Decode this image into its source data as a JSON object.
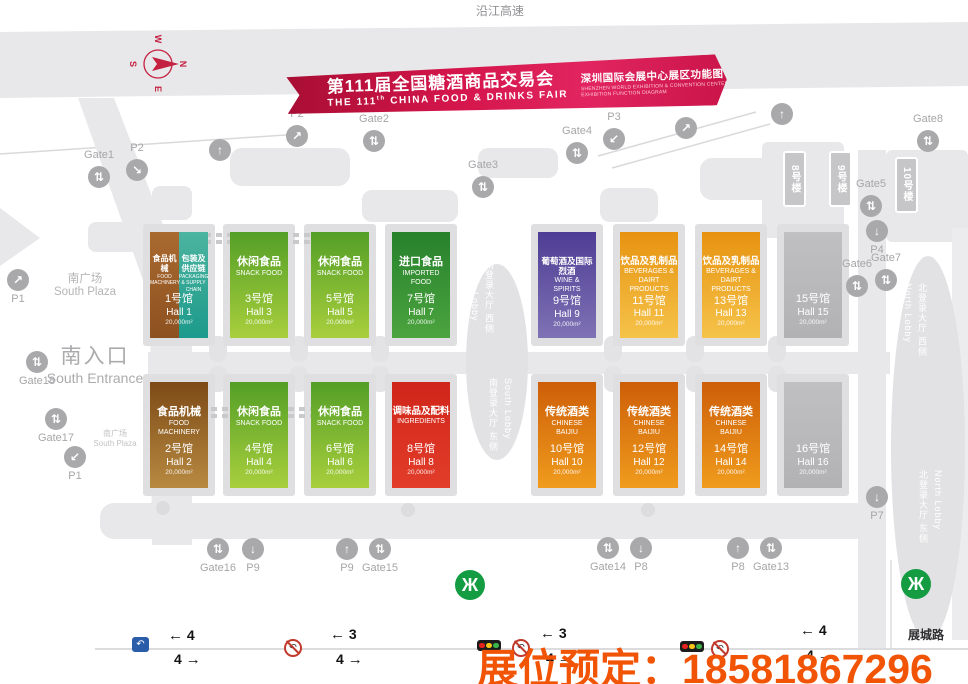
{
  "page": {
    "highway_label": "沿江高速",
    "road_label": "展城路",
    "booking_overlay": "展位预定：18581867296",
    "booking_color": "#f25405"
  },
  "banner": {
    "title_cn": "第111届全国糖酒商品交易会",
    "title_en_prefix": "THE 111",
    "title_en_sup": "th",
    "title_en_suffix": " CHINA FOOD & DRINKS FAIR",
    "subtitle_cn": "深圳国际会展中心展区功能图",
    "subtitle_en_line1": "SHENZHEN WORLD EXHIBITION & CONVENTION CENTER",
    "subtitle_en_line2": "EXHIBITION FUNCTION DIAGRAM"
  },
  "compass": {
    "letters": [
      "N",
      "E",
      "S",
      "W"
    ]
  },
  "areas": {
    "south_plaza": {
      "cn": "南广场",
      "en": "South Plaza"
    },
    "south_plaza_small": {
      "cn": "南广场",
      "en": "South Plaza"
    },
    "south_entrance": {
      "cn": "南入口",
      "en": "South Entrance"
    },
    "south_lobby_west": {
      "cn": "南登录大厅 西侧",
      "en": "South Lobby"
    },
    "south_lobby_east": {
      "cn": "南登录大厅 东侧",
      "en": "South Lobby"
    },
    "north_lobby_west": {
      "cn": "北登录大厅 西侧",
      "en": "North Lobby"
    },
    "north_lobby_east": {
      "cn": "北登录大厅 东侧",
      "en": "North Lobby"
    }
  },
  "buildings": [
    {
      "label": "8号楼",
      "x": 783,
      "y": 151
    },
    {
      "label": "9号楼",
      "x": 829,
      "y": 151
    },
    {
      "label": "10号楼",
      "x": 895,
      "y": 157
    }
  ],
  "halls": [
    {
      "num": "1",
      "row": 1,
      "col": 0,
      "split": true,
      "name_cn": "食品机械",
      "name_en": "FOOD MACHINERY",
      "name2_cn": "包装及供应链",
      "name2_en": "PACKAGING & SUPPLY CHAIN",
      "hall_cn": "1号馆",
      "hall_en": "Hall 1",
      "area": "20,000m²",
      "color_top": "#a96a30",
      "color_bottom": "#8d5120",
      "color2_top": "#4cb4a0",
      "color2_bottom": "#1c9a8b"
    },
    {
      "num": "3",
      "row": 1,
      "col": 1,
      "name_cn": "休闲食品",
      "name_en": "SNACK FOOD",
      "hall_cn": "3号馆",
      "hall_en": "Hall 3",
      "area": "20,000m²",
      "color_top": "#549f27",
      "color_bottom": "#a9cf3d"
    },
    {
      "num": "5",
      "row": 1,
      "col": 2,
      "name_cn": "休闲食品",
      "name_en": "SNACK FOOD",
      "hall_cn": "5号馆",
      "hall_en": "Hall 5",
      "area": "20,000m²",
      "color_top": "#549f27",
      "color_bottom": "#a9cf3d"
    },
    {
      "num": "7",
      "row": 1,
      "col": 3,
      "name_cn": "进口食品",
      "name_en": "IMPORTED FOOD",
      "hall_cn": "7号馆",
      "hall_en": "Hall 7",
      "area": "20,000m²",
      "color_top": "#27812c",
      "color_bottom": "#4ba43e"
    },
    {
      "num": "9",
      "row": 1,
      "col": 4,
      "name_cn": "葡萄酒及国际烈酒",
      "name_en": "WINE & SPIRITS",
      "hall_cn": "9号馆",
      "hall_en": "Hall 9",
      "area": "20,000m²",
      "color_top": "#4e3d95",
      "color_bottom": "#7f72b4"
    },
    {
      "num": "11",
      "row": 1,
      "col": 5,
      "name_cn": "饮品及乳制品",
      "name_en": "BEVERAGES & DAIRT PRODUCTS",
      "hall_cn": "11号馆",
      "hall_en": "Hall 11",
      "area": "20,000m²",
      "color_top": "#e79310",
      "color_bottom": "#f5c34a"
    },
    {
      "num": "13",
      "row": 1,
      "col": 6,
      "name_cn": "饮品及乳制品",
      "name_en": "BEVERAGES & DAIRT PRODUCTS",
      "hall_cn": "13号馆",
      "hall_en": "Hall 13",
      "area": "20,000m²",
      "color_top": "#e79310",
      "color_bottom": "#f5c34a"
    },
    {
      "num": "15",
      "row": 1,
      "col": 7,
      "name_cn": "",
      "name_en": "",
      "hall_cn": "15号馆",
      "hall_en": "Hall 15",
      "area": "20,000m²",
      "color_top": "#c0c0c2",
      "color_bottom": "#b2b2b4"
    },
    {
      "num": "2",
      "row": 2,
      "col": 0,
      "name_cn": "食品机械",
      "name_en": "FOOD MACHINERY",
      "hall_cn": "2号馆",
      "hall_en": "Hall 2",
      "area": "20,000m²",
      "color_top": "#7d4a16",
      "color_bottom": "#b78a41"
    },
    {
      "num": "4",
      "row": 2,
      "col": 1,
      "name_cn": "休闲食品",
      "name_en": "SNACK FOOD",
      "hall_cn": "4号馆",
      "hall_en": "Hall 4",
      "area": "20,000m²",
      "color_top": "#549f27",
      "color_bottom": "#a9cf3d"
    },
    {
      "num": "6",
      "row": 2,
      "col": 2,
      "name_cn": "休闲食品",
      "name_en": "SNACK FOOD",
      "hall_cn": "6号馆",
      "hall_en": "Hall 6",
      "area": "20,000m²",
      "color_top": "#549f27",
      "color_bottom": "#a9cf3d"
    },
    {
      "num": "8",
      "row": 2,
      "col": 3,
      "name_cn": "调味品及配料",
      "name_en": "INGREDIENTS",
      "hall_cn": "8号馆",
      "hall_en": "Hall 8",
      "area": "20,000m²",
      "color_top": "#d0251a",
      "color_bottom": "#e23d2a"
    },
    {
      "num": "10",
      "row": 2,
      "col": 4,
      "name_cn": "传统酒类",
      "name_en": "CHINESE BAIJIU",
      "hall_cn": "10号馆",
      "hall_en": "Hall 10",
      "area": "20,000m²",
      "color_top": "#cd5e08",
      "color_bottom": "#f09c1d"
    },
    {
      "num": "12",
      "row": 2,
      "col": 5,
      "name_cn": "传统酒类",
      "name_en": "CHINESE BAIJIU",
      "hall_cn": "12号馆",
      "hall_en": "Hall 12",
      "area": "20,000m²",
      "color_top": "#cd5e08",
      "color_bottom": "#f09c1d"
    },
    {
      "num": "14",
      "row": 2,
      "col": 6,
      "name_cn": "传统酒类",
      "name_en": "CHINESE BAIJIU",
      "hall_cn": "14号馆",
      "hall_en": "Hall 14",
      "area": "20,000m²",
      "color_top": "#cd5e08",
      "color_bottom": "#f09c1d"
    },
    {
      "num": "16",
      "row": 2,
      "col": 7,
      "name_cn": "",
      "name_en": "",
      "hall_cn": "16号馆",
      "hall_en": "Hall 16",
      "area": "20,000m²",
      "color_top": "#c0c0c2",
      "color_bottom": "#b2b2b4"
    }
  ],
  "gates": [
    {
      "label": "Gate1",
      "cx": 99,
      "cy": 177,
      "arrow": "⇅",
      "label_pos": "above"
    },
    {
      "label": "P2",
      "cx": 137,
      "cy": 170,
      "arrow": "↘",
      "label_pos": "above"
    },
    {
      "label": "",
      "cx": 220,
      "cy": 150,
      "arrow": "↑",
      "label_pos": "above"
    },
    {
      "label": "P2",
      "cx": 297,
      "cy": 136,
      "arrow": "↗",
      "label_pos": "above"
    },
    {
      "label": "Gate2",
      "cx": 374,
      "cy": 141,
      "arrow": "⇅",
      "label_pos": "above"
    },
    {
      "label": "Gate3",
      "cx": 483,
      "cy": 187,
      "arrow": "⇅",
      "label_pos": "above"
    },
    {
      "label": "Gate4",
      "cx": 577,
      "cy": 153,
      "arrow": "⇅",
      "label_pos": "above"
    },
    {
      "label": "P3",
      "cx": 614,
      "cy": 139,
      "arrow": "↙",
      "label_pos": "above"
    },
    {
      "label": "",
      "cx": 686,
      "cy": 128,
      "arrow": "↗",
      "label_pos": "above"
    },
    {
      "label": "",
      "cx": 782,
      "cy": 114,
      "arrow": "↑",
      "label_pos": "above"
    },
    {
      "label": "Gate8",
      "cx": 928,
      "cy": 141,
      "arrow": "⇅",
      "label_pos": "above"
    },
    {
      "label": "Gate5",
      "cx": 871,
      "cy": 206,
      "arrow": "⇅",
      "label_pos": "above"
    },
    {
      "label": "P4",
      "cx": 877,
      "cy": 231,
      "arrow": "↓",
      "label_pos": "below"
    },
    {
      "label": "Gate6",
      "cx": 857,
      "cy": 286,
      "arrow": "⇅",
      "label_pos": "above"
    },
    {
      "label": "Gate7",
      "cx": 886,
      "cy": 280,
      "arrow": "⇅",
      "label_pos": "above"
    },
    {
      "label": "P1",
      "cx": 18,
      "cy": 280,
      "arrow": "↗",
      "label_pos": "below"
    },
    {
      "label": "Gate18",
      "cx": 37,
      "cy": 362,
      "arrow": "⇅",
      "label_pos": "below"
    },
    {
      "label": "Gate17",
      "cx": 56,
      "cy": 419,
      "arrow": "⇅",
      "label_pos": "below"
    },
    {
      "label": "P1",
      "cx": 75,
      "cy": 457,
      "arrow": "↙",
      "label_pos": "below"
    },
    {
      "label": "Gate16",
      "cx": 218,
      "cy": 549,
      "arrow": "⇅",
      "label_pos": "below"
    },
    {
      "label": "P9",
      "cx": 253,
      "cy": 549,
      "arrow": "↓",
      "label_pos": "below"
    },
    {
      "label": "P9",
      "cx": 347,
      "cy": 549,
      "arrow": "↑",
      "label_pos": "below"
    },
    {
      "label": "Gate15",
      "cx": 380,
      "cy": 549,
      "arrow": "⇅",
      "label_pos": "below"
    },
    {
      "label": "Gate14",
      "cx": 608,
      "cy": 548,
      "arrow": "⇅",
      "label_pos": "below"
    },
    {
      "label": "P8",
      "cx": 641,
      "cy": 548,
      "arrow": "↓",
      "label_pos": "below"
    },
    {
      "label": "P8",
      "cx": 738,
      "cy": 548,
      "arrow": "↑",
      "label_pos": "below"
    },
    {
      "label": "Gate13",
      "cx": 771,
      "cy": 548,
      "arrow": "⇅",
      "label_pos": "below"
    },
    {
      "label": "P7",
      "cx": 877,
      "cy": 497,
      "arrow": "↓",
      "label_pos": "below"
    }
  ],
  "traffic_sections": [
    {
      "x": 168,
      "y_top": 627,
      "y_bot": 651,
      "left": "4",
      "right": "4"
    },
    {
      "x": 330,
      "y_top": 626,
      "y_bot": 651,
      "left": "3",
      "right": "4"
    },
    {
      "x": 540,
      "y_top": 625,
      "y_bot": 650,
      "left": "3",
      "right": "4"
    },
    {
      "x": 800,
      "y_top": 622,
      "y_bot": 647,
      "left": "4",
      "right": "4"
    }
  ],
  "road_signs": [
    {
      "type": "uturn-ok",
      "x": 132,
      "y": 637
    },
    {
      "type": "no-uturn",
      "x": 284,
      "y": 639
    },
    {
      "type": "traffic-light",
      "x": 477,
      "y": 640
    },
    {
      "type": "no-uturn",
      "x": 512,
      "y": 639
    },
    {
      "type": "traffic-light",
      "x": 680,
      "y": 641
    },
    {
      "type": "no-uturn",
      "x": 711,
      "y": 640
    }
  ],
  "metro_stations": [
    {
      "x": 470,
      "y": 585
    },
    {
      "x": 916,
      "y": 584
    }
  ]
}
